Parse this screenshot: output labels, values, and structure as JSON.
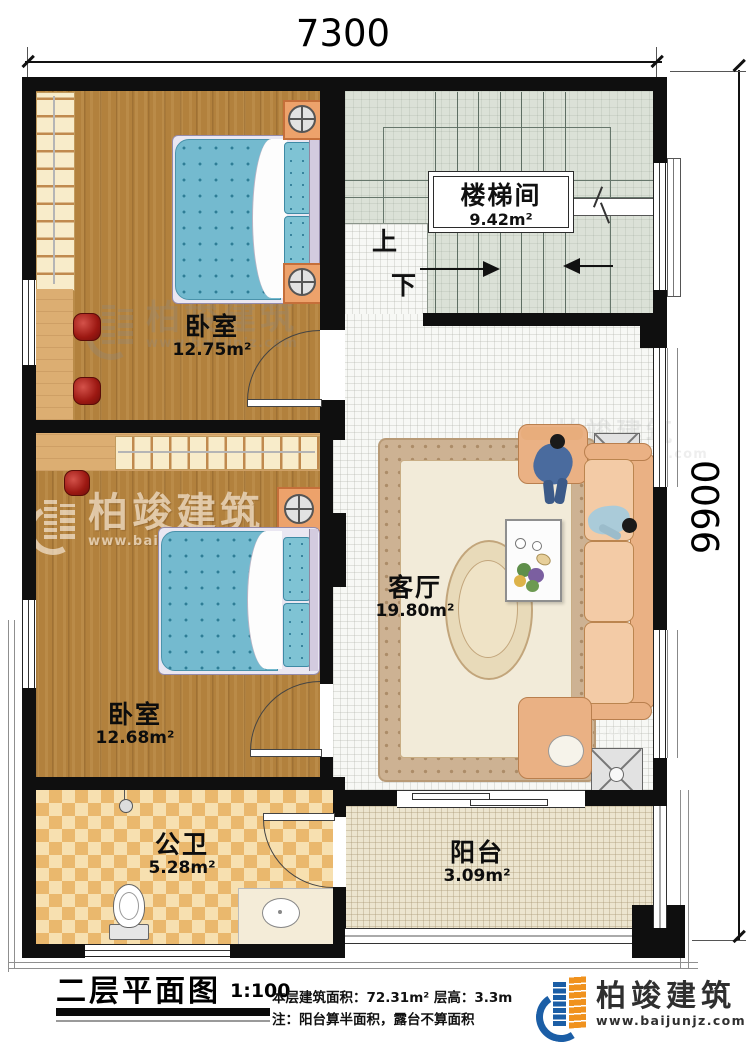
{
  "dimensions": {
    "width_mm": "7300",
    "height_mm": "9900"
  },
  "rooms": {
    "stairwell": {
      "name": "楼梯间",
      "area": "9.42m²"
    },
    "bedroom_top": {
      "name": "卧室",
      "area": "12.75m²"
    },
    "bedroom_bottom": {
      "name": "卧室",
      "area": "12.68m²"
    },
    "living_room": {
      "name": "客厅",
      "area": "19.80m²"
    },
    "bathroom": {
      "name": "公卫",
      "area": "5.28m²"
    },
    "balcony": {
      "name": "阳台",
      "area": "3.09m²"
    }
  },
  "stairs": {
    "up_label": "上",
    "down_label": "下"
  },
  "title_block": {
    "title": "二层平面图",
    "scale": "1:100",
    "area_note": "本层建筑面积：72.31m²  层高：3.3m",
    "note": "注：阳台算半面积，露台不算面积",
    "brand_name": "柏竣建筑",
    "brand_url": "www.baijunjz.com"
  },
  "watermark": {
    "text": "柏竣建筑",
    "url": "www.baijunjz.com"
  },
  "colors": {
    "wall": "#0f0f0f",
    "wood_floor": "#b2813d",
    "stair_floor": "#dbe1d7",
    "bathroom_tile": "#eab86d",
    "balcony_floor": "#ece5cf",
    "mattress": "#74bacf",
    "sofa": "#eab184",
    "brand_blue": "#1b5ea6",
    "brand_orange": "#f0921e"
  }
}
